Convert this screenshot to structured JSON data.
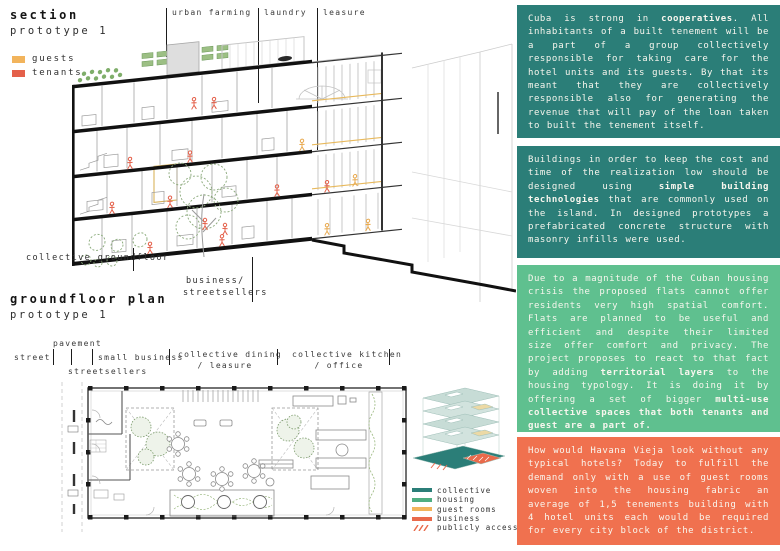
{
  "section_panel": {
    "title": "section",
    "subtitle": "prototype 1",
    "legend": [
      {
        "label": "guests",
        "color": "#F2B45C"
      },
      {
        "label": "tenants",
        "color": "#E4604A"
      }
    ],
    "callouts": [
      {
        "label": "urban farming"
      },
      {
        "label": "laundry"
      },
      {
        "label": "leasure"
      }
    ],
    "annotations": {
      "collective_groundfloor": "collective groundfloor",
      "business": "business/",
      "streetsellers": "streetsellers"
    }
  },
  "plan_panel": {
    "title": "groundfloor plan",
    "subtitle": "prototype 1",
    "zones": {
      "street": "street",
      "pavement": "pavement",
      "streetsellers": "streetsellers",
      "small_business": "small business",
      "dining_line1": "collective dining",
      "dining_line2": "/ leasure",
      "kitchen_line1": "collective kitchen",
      "kitchen_line2": "/ office"
    }
  },
  "stack_legend": {
    "items": [
      {
        "label": "collective",
        "color": "#2B7E78"
      },
      {
        "label": "housing",
        "color": "#4FAE82"
      },
      {
        "label": "guest rooms",
        "color": "#F2B45C"
      },
      {
        "label": "business",
        "color": "#E96A4B"
      },
      {
        "label": "publicly accessible",
        "color": "#E96A4B"
      }
    ]
  },
  "text_blocks": [
    {
      "bg": "#2B7E78",
      "segments": [
        {
          "t": "Cuba is strong in "
        },
        {
          "t": "cooperatives",
          "b": true
        },
        {
          "t": ". All inhabitants of a built tenement will be a part of a group collectively responsible for taking care for the hotel units and its guests. By that its meant that they are collectively responsible also for generating the revenue that will pay of the loan taken to built the tenement itself."
        }
      ]
    },
    {
      "bg": "#2B7E78",
      "segments": [
        {
          "t": "Buildings in order to keep the cost and time of the realization low should be designed using "
        },
        {
          "t": "simple building technologies",
          "b": true
        },
        {
          "t": " that are commonly used on the island. In designed prototypes a prefabricated concrete structure with masonry infills were used."
        }
      ]
    },
    {
      "bg": "#5FC08F",
      "segments": [
        {
          "t": "Due to a magnitude of the Cuban housing crisis the proposed flats cannot offer residents very high spatial comfort. Flats are planned to be useful and efficient and despite their limited size offer comfort and privacy. The project proposes to react to that fact by adding "
        },
        {
          "t": "territorial layers",
          "b": true
        },
        {
          "t": " to the housing typology. It is doing it by offering a set of bigger "
        },
        {
          "t": "multi-use collective spaces that both tenants and guest are a part of.",
          "b": true
        }
      ]
    },
    {
      "bg": "#F0714F",
      "segments": [
        {
          "t": "How would Havana Vieja look without any typical hotels? Today to fulfill the demand only with a use of guest rooms woven into the housing fabric an average of 1,5 tenements building with 4 hotel units each would be required for every city block of the district."
        }
      ]
    }
  ],
  "colors": {
    "teal": "#2B7E78",
    "green": "#5FC08F",
    "coral": "#F0714F",
    "guests_orange": "#F2B45C",
    "tenants_red": "#E4604A"
  }
}
